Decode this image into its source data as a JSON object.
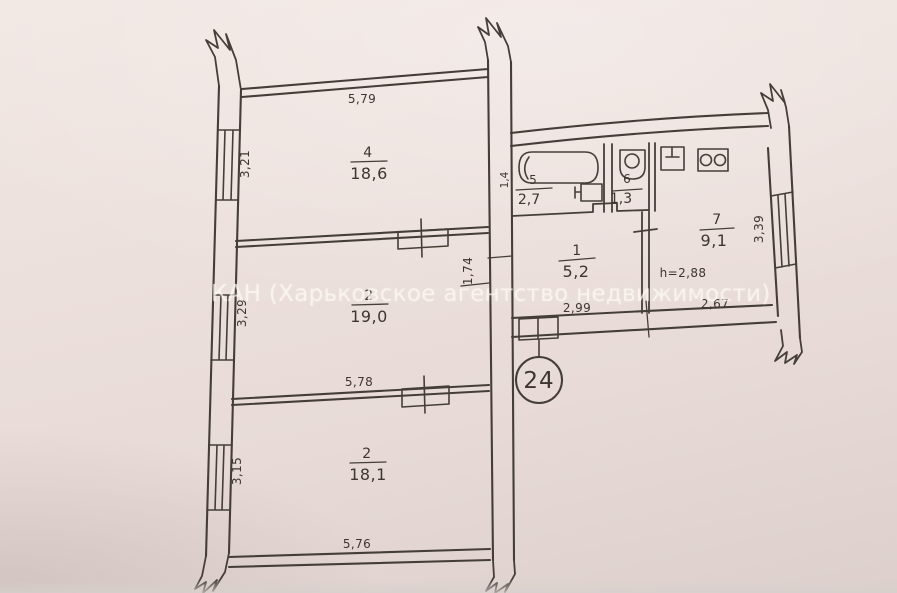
{
  "watermark": "КАН (Харьковское агентство недвижимости)",
  "apartment_badge": "24",
  "ceiling_height_label": "h=2,88",
  "rooms": {
    "living_top": {
      "number": "4",
      "area": "18,6"
    },
    "living_mid": {
      "number": "2",
      "area": "19,0"
    },
    "living_bottom": {
      "number": "2",
      "area": "18,1"
    },
    "hallway": {
      "number": "1",
      "area": "5,2"
    },
    "bathroom": {
      "number": "5",
      "area": "2,7"
    },
    "wc": {
      "number": "6",
      "area": "1,3"
    },
    "kitchen": {
      "number": "7",
      "area": "9,1"
    }
  },
  "dimensions": {
    "top_width": "5,79",
    "mid_width": "5,78",
    "bottom_width": "5,76",
    "window_top": "3,21",
    "window_mid": "3,29",
    "window_bottom": "3,15",
    "bath_width": "1,4",
    "hall_depth": "1,74",
    "hall_width": "2,99",
    "kitchen_width": "2,67",
    "right_window": "3,39"
  },
  "colors": {
    "paper": "#ebdfdb",
    "ink": "#453e38",
    "watermark_text": "rgba(255,252,248,0.62)"
  }
}
